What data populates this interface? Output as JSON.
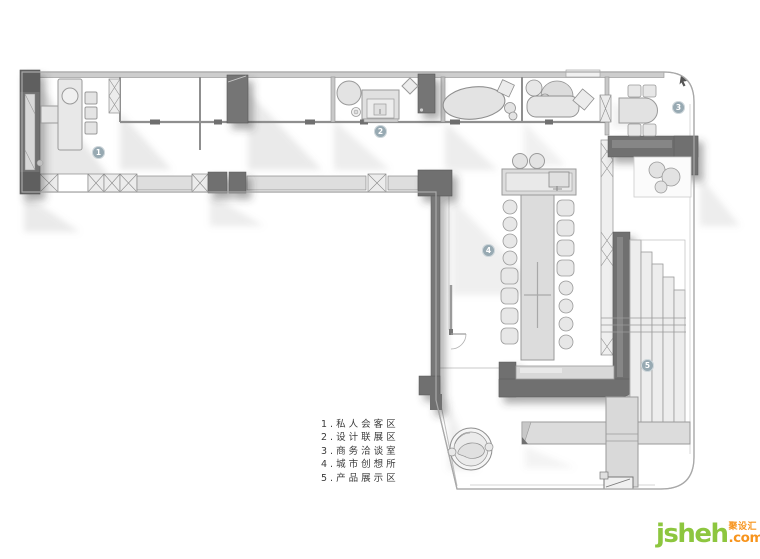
{
  "legend": {
    "items": [
      "1.私人会客区",
      "2.设计联展区",
      "3.商务洽谈室",
      "4.城市创想所",
      "5.产品展示区"
    ]
  },
  "markers": [
    {
      "num": "1"
    },
    {
      "num": "2"
    },
    {
      "num": "3"
    },
    {
      "num": "4"
    },
    {
      "num": "5"
    }
  ],
  "logo": {
    "name": "jsheh",
    "cn": "聚设汇",
    "tld": ".com"
  },
  "colors": {
    "wall_dark": "#6f6f6f",
    "floor": "#ffffff",
    "hatch_fill": "#ececec",
    "furniture_fill": "#e3e3e3",
    "marker_badge": "#97a9b2",
    "logo_green": "#8dc63f",
    "logo_orange": "#f7941d"
  }
}
